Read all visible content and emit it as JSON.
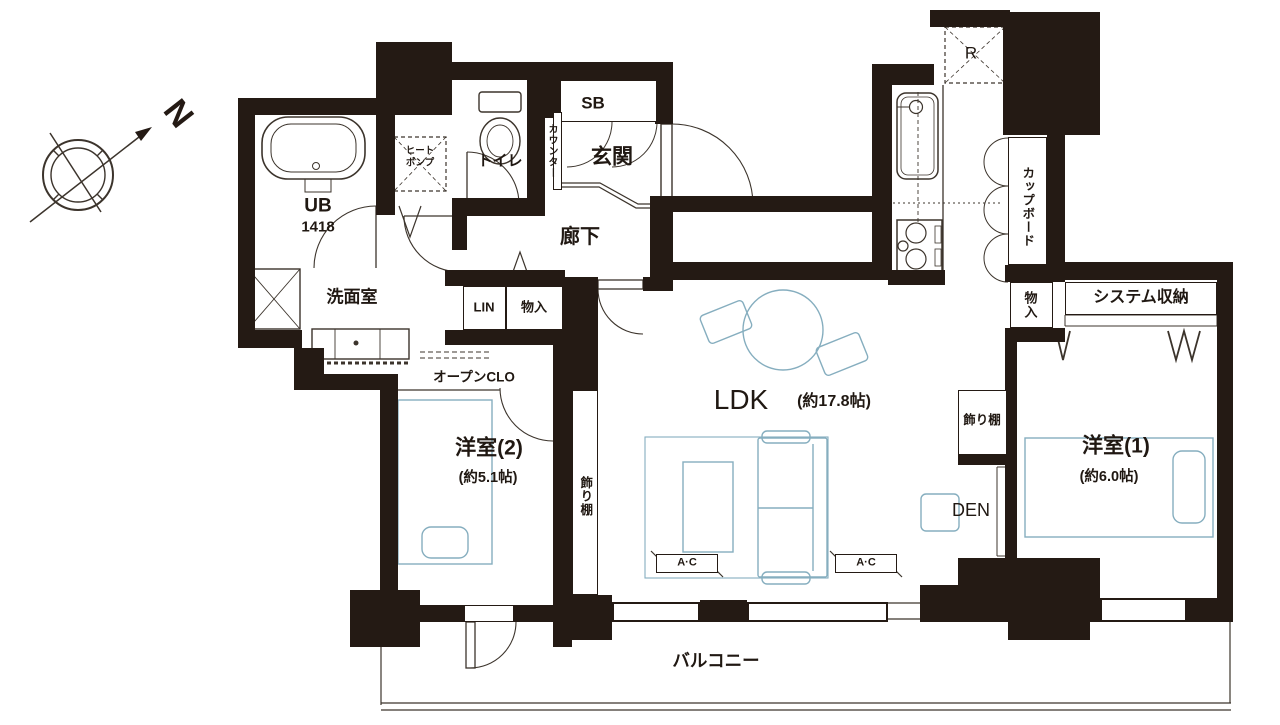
{
  "compass": {
    "north": "N"
  },
  "labels": {
    "ub_name": "UB",
    "ub_size": "1418",
    "heat_pump_1": "ヒート",
    "heat_pump_2": "ポンプ",
    "toilet": "トイレ",
    "counter": "カウンター",
    "shoe_box": "SB",
    "entrance": "玄関",
    "hallway": "廊下",
    "refrigerator": "R",
    "cupboard": "カップボード",
    "kitchen_storage": "物入",
    "system_storage": "システム収納",
    "washroom": "洗面室",
    "linen": "LIN",
    "hall_storage": "物入",
    "open_closet": "オープンCLO",
    "bedroom2_name": "洋室(2)",
    "bedroom2_size": "(約5.1帖)",
    "shelf_left": "飾り棚",
    "ldk_name": "LDK",
    "ldk_size": "(約17.8帖)",
    "shelf_right": "飾り棚",
    "den": "DEN",
    "bedroom1_name": "洋室(1)",
    "bedroom1_size": "(約6.0帖)",
    "ac": "A·C",
    "balcony": "バルコニー"
  },
  "colors": {
    "wall": "#241a14",
    "fixture_line": "#3c342c",
    "furniture_line": "#86aebf"
  }
}
